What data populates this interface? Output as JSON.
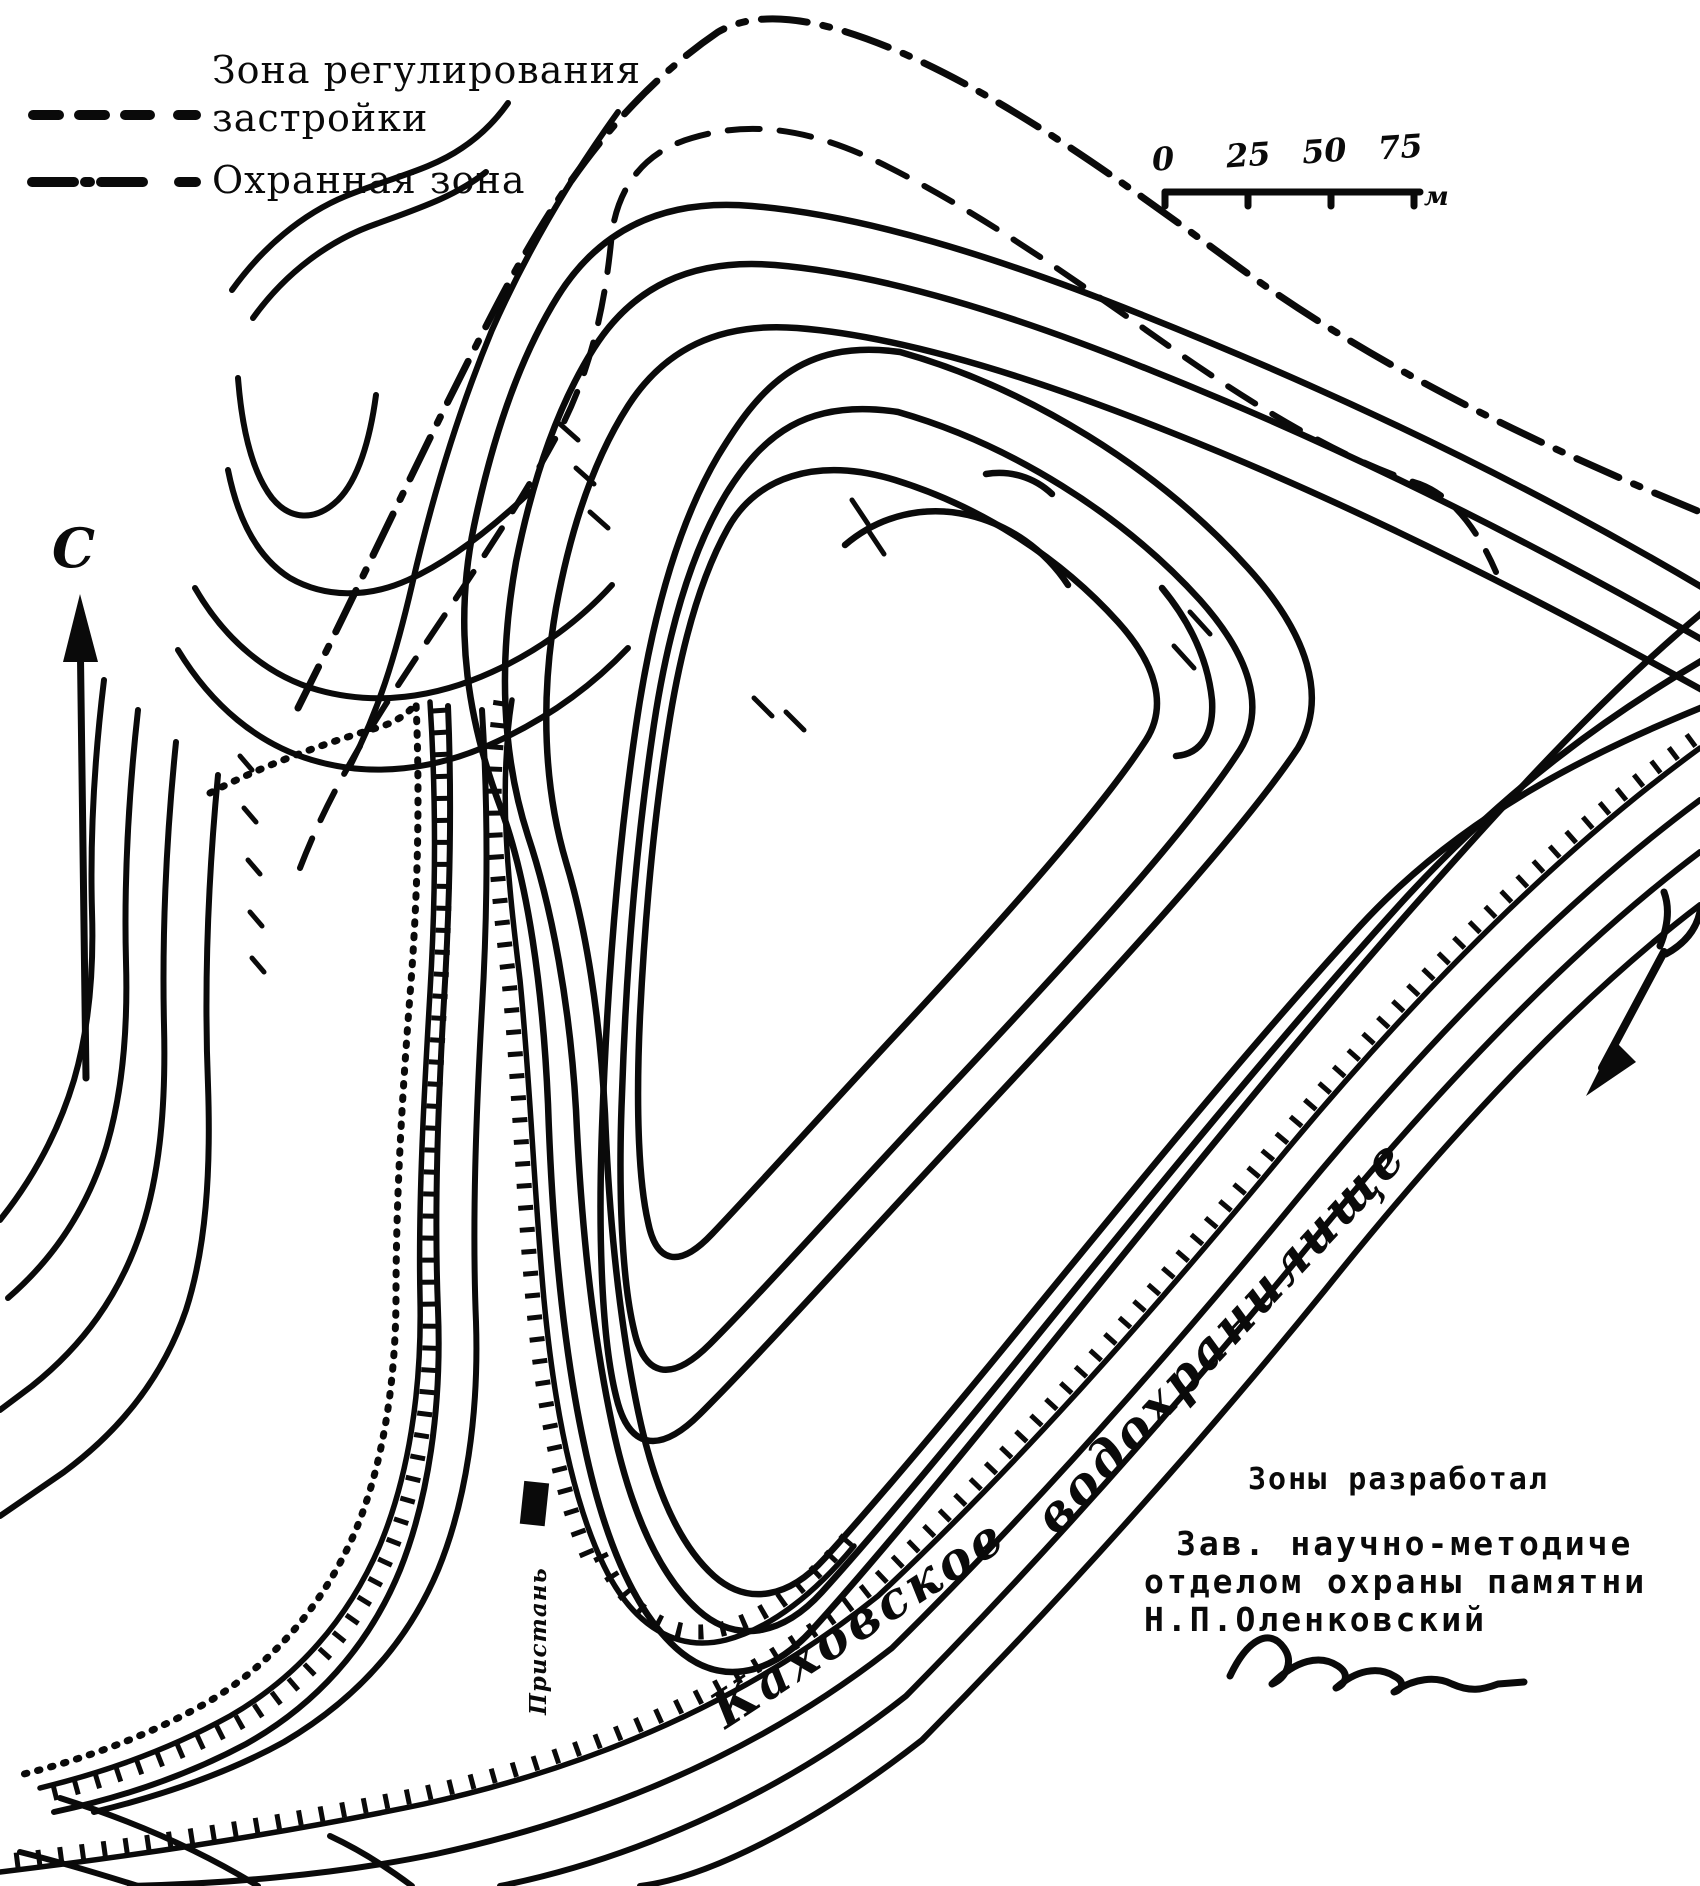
{
  "legend": {
    "items": [
      {
        "style": "dashed",
        "label_line1": "Зона регулирования",
        "label_line2": "застройки"
      },
      {
        "style": "dash-dot",
        "label_line1": "Охранная зона",
        "label_line2": ""
      }
    ]
  },
  "scale_bar": {
    "ticks": [
      "0",
      "25",
      "50",
      "75"
    ],
    "unit": "м"
  },
  "north": {
    "label": "С"
  },
  "water": {
    "name_line1": "Каховское",
    "name_line2": "водохранилище"
  },
  "site": {
    "pier_label": "Пристань"
  },
  "credits": {
    "line1": "Зоны разработал",
    "line2": "Зав. научно-методиче",
    "line3": "отделом охраны памятни",
    "line4": "Н.П.Оленковский"
  },
  "colors": {
    "ink": "#0a0a0a",
    "paper": "#ffffff"
  }
}
